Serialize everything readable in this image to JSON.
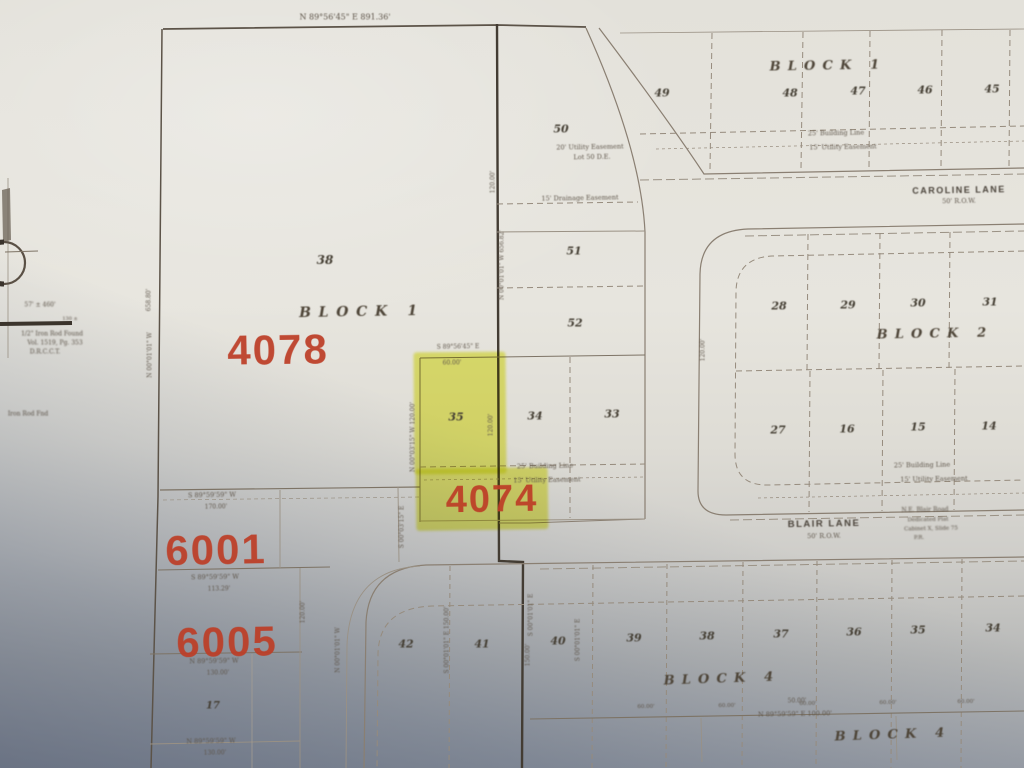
{
  "summary": {
    "highlighted_lot": "35",
    "stamps": [
      "4078",
      "4074",
      "6001",
      "6005"
    ],
    "streets": [
      "CAROLINE LANE",
      "BLAIR LANE"
    ],
    "blocks": [
      "BLOCK 1",
      "BLOCK 2",
      "BLOCK 4"
    ]
  },
  "labels": [
    {
      "name": "stamp-4078",
      "cls": "stamp",
      "text": "4078",
      "x": 278,
      "y": 350,
      "fs": 42,
      "rot": -1
    },
    {
      "name": "stamp-4074",
      "cls": "stamp",
      "text": "4074",
      "x": 492,
      "y": 500,
      "fs": 38,
      "rot": -1
    },
    {
      "name": "stamp-6001",
      "cls": "stamp",
      "text": "6001",
      "x": 216,
      "y": 550,
      "fs": 42,
      "rot": -1
    },
    {
      "name": "stamp-6005",
      "cls": "stamp",
      "text": "6005",
      "x": 227,
      "y": 642,
      "fs": 42,
      "rot": -1
    },
    {
      "name": "block1-right-label",
      "cls": "block",
      "text": "BLOCK 1",
      "x": 828,
      "y": 66,
      "fs": 13,
      "rot": -1
    },
    {
      "name": "block1-left-label",
      "cls": "block",
      "text": "BLOCK 1",
      "x": 362,
      "y": 312,
      "fs": 14,
      "rot": -1
    },
    {
      "name": "block2-label",
      "cls": "block",
      "text": "BLOCK 2",
      "x": 935,
      "y": 334,
      "fs": 13,
      "rot": -1
    },
    {
      "name": "block4-label",
      "cls": "block",
      "text": "BLOCK 4",
      "x": 722,
      "y": 679,
      "fs": 13,
      "rot": -2
    },
    {
      "name": "block4-label-2",
      "cls": "block",
      "text": "BLOCK 4",
      "x": 893,
      "y": 735,
      "fs": 13,
      "rot": -2
    },
    {
      "name": "street-caroline-label",
      "cls": "street",
      "text": "CAROLINE LANE",
      "x": 959,
      "y": 190,
      "fs": 9,
      "rot": -1
    },
    {
      "name": "street-caroline-row",
      "cls": "small",
      "text": "50' R.O.W.",
      "x": 959,
      "y": 201,
      "fs": 6.5,
      "rot": -1
    },
    {
      "name": "street-blair-label",
      "cls": "street",
      "text": "BLAIR LANE",
      "x": 824,
      "y": 524,
      "fs": 9.5,
      "rot": -1
    },
    {
      "name": "street-blair-row",
      "cls": "small",
      "text": "50' R.O.W.",
      "x": 824,
      "y": 536,
      "fs": 6.5,
      "rot": -1
    },
    {
      "name": "lot-49",
      "cls": "lot",
      "text": "49",
      "x": 662,
      "y": 93,
      "fs": 11,
      "rot": 0
    },
    {
      "name": "lot-48",
      "cls": "lot",
      "text": "48",
      "x": 790,
      "y": 93,
      "fs": 11,
      "rot": 0
    },
    {
      "name": "lot-47",
      "cls": "lot",
      "text": "47",
      "x": 858,
      "y": 91,
      "fs": 11,
      "rot": 0
    },
    {
      "name": "lot-46",
      "cls": "lot",
      "text": "46",
      "x": 925,
      "y": 90,
      "fs": 11,
      "rot": 0
    },
    {
      "name": "lot-45",
      "cls": "lot",
      "text": "45",
      "x": 992,
      "y": 89,
      "fs": 11,
      "rot": 0
    },
    {
      "name": "lot-50",
      "cls": "lot",
      "text": "50",
      "x": 561,
      "y": 129,
      "fs": 11,
      "rot": 0
    },
    {
      "name": "lot-38",
      "cls": "lot",
      "text": "38",
      "x": 325,
      "y": 260,
      "fs": 12,
      "rot": 0
    },
    {
      "name": "lot-51",
      "cls": "lot",
      "text": "51",
      "x": 574,
      "y": 251,
      "fs": 11,
      "rot": 0
    },
    {
      "name": "lot-52",
      "cls": "lot",
      "text": "52",
      "x": 575,
      "y": 323,
      "fs": 11,
      "rot": 0
    },
    {
      "name": "lot-35-highlighted",
      "cls": "lot",
      "text": "35",
      "x": 456,
      "y": 417,
      "fs": 11,
      "rot": 0
    },
    {
      "name": "lot-34",
      "cls": "lot",
      "text": "34",
      "x": 535,
      "y": 416,
      "fs": 11,
      "rot": 0
    },
    {
      "name": "lot-33",
      "cls": "lot",
      "text": "33",
      "x": 612,
      "y": 414,
      "fs": 11,
      "rot": 0
    },
    {
      "name": "lot-28",
      "cls": "lot",
      "text": "28",
      "x": 779,
      "y": 306,
      "fs": 11,
      "rot": 0
    },
    {
      "name": "lot-29",
      "cls": "lot",
      "text": "29",
      "x": 848,
      "y": 305,
      "fs": 11,
      "rot": 0
    },
    {
      "name": "lot-30",
      "cls": "lot",
      "text": "30",
      "x": 918,
      "y": 303,
      "fs": 11,
      "rot": 0
    },
    {
      "name": "lot-31",
      "cls": "lot",
      "text": "31",
      "x": 990,
      "y": 302,
      "fs": 11,
      "rot": 0
    },
    {
      "name": "lot-27",
      "cls": "lot",
      "text": "27",
      "x": 778,
      "y": 430,
      "fs": 11,
      "rot": 0
    },
    {
      "name": "lot-16",
      "cls": "lot",
      "text": "16",
      "x": 847,
      "y": 429,
      "fs": 11,
      "rot": 0
    },
    {
      "name": "lot-15",
      "cls": "lot",
      "text": "15",
      "x": 918,
      "y": 427,
      "fs": 11,
      "rot": 0
    },
    {
      "name": "lot-14",
      "cls": "lot",
      "text": "14",
      "x": 989,
      "y": 426,
      "fs": 11,
      "rot": 0
    },
    {
      "name": "lot-42",
      "cls": "lot",
      "text": "42",
      "x": 406,
      "y": 644,
      "fs": 11,
      "rot": 0
    },
    {
      "name": "lot-41",
      "cls": "lot",
      "text": "41",
      "x": 482,
      "y": 644,
      "fs": 11,
      "rot": 0
    },
    {
      "name": "lot-40",
      "cls": "lot",
      "text": "40",
      "x": 558,
      "y": 641,
      "fs": 11,
      "rot": 0
    },
    {
      "name": "lot-39",
      "cls": "lot",
      "text": "39",
      "x": 634,
      "y": 638,
      "fs": 11,
      "rot": 0
    },
    {
      "name": "lot-38b",
      "cls": "lot",
      "text": "38",
      "x": 707,
      "y": 636,
      "fs": 11,
      "rot": 0
    },
    {
      "name": "lot-37",
      "cls": "lot",
      "text": "37",
      "x": 781,
      "y": 634,
      "fs": 11,
      "rot": 0
    },
    {
      "name": "lot-36",
      "cls": "lot",
      "text": "36",
      "x": 854,
      "y": 632,
      "fs": 11,
      "rot": 0
    },
    {
      "name": "lot-35b",
      "cls": "lot",
      "text": "35",
      "x": 918,
      "y": 630,
      "fs": 11,
      "rot": 0
    },
    {
      "name": "lot-34b",
      "cls": "lot",
      "text": "34",
      "x": 993,
      "y": 628,
      "fs": 11,
      "rot": 0
    },
    {
      "name": "lot-17",
      "cls": "lot",
      "text": "17",
      "x": 213,
      "y": 706,
      "fs": 10,
      "rot": 0
    },
    {
      "name": "easement-building-ne",
      "cls": "small",
      "text": "25' Building Line",
      "x": 836,
      "y": 133,
      "fs": 6.5,
      "rot": -1
    },
    {
      "name": "easement-utility-ne",
      "cls": "small",
      "text": "15' Utility Easement",
      "x": 843,
      "y": 147,
      "fs": 6.5,
      "rot": -1
    },
    {
      "name": "easement-utility-lot50",
      "cls": "small",
      "text": "20' Utility Easement",
      "x": 590,
      "y": 147,
      "fs": 6.5,
      "rot": -1
    },
    {
      "name": "easement-lot50-note",
      "cls": "small",
      "text": "Lot 50 D.E.",
      "x": 592,
      "y": 157,
      "fs": 6.5,
      "rot": -1
    },
    {
      "name": "easement-drainage",
      "cls": "small",
      "text": "15' Drainage Easement",
      "x": 580,
      "y": 198,
      "fs": 6.5,
      "rot": -1
    },
    {
      "name": "easement-building-mid",
      "cls": "small",
      "text": "25' Building Line",
      "x": 545,
      "y": 466,
      "fs": 6.5,
      "rot": -1
    },
    {
      "name": "easement-utility-mid",
      "cls": "small",
      "text": "15' Utility Easement",
      "x": 547,
      "y": 480,
      "fs": 6.5,
      "rot": -1
    },
    {
      "name": "easement-building-b2",
      "cls": "small",
      "text": "25' Building Line",
      "x": 922,
      "y": 465,
      "fs": 6.5,
      "rot": -1
    },
    {
      "name": "easement-utility-b2",
      "cls": "small",
      "text": "15' Utility Easement",
      "x": 934,
      "y": 479,
      "fs": 6.5,
      "rot": -1
    },
    {
      "name": "bearing-top",
      "cls": "small",
      "text": "N 89°56'45\" E   891.36'",
      "x": 345,
      "y": 17,
      "fs": 8,
      "rot": 0
    },
    {
      "name": "bearing-lot35-top",
      "cls": "small",
      "text": "S 89°56'45\" E",
      "x": 458,
      "y": 347,
      "fs": 6,
      "rot": -1
    },
    {
      "name": "dim-lot35",
      "cls": "small",
      "text": "60.00'",
      "x": 452,
      "y": 363,
      "fs": 6,
      "rot": -1
    },
    {
      "name": "bearing-6001-n",
      "cls": "small",
      "text": "S 89°59'59\" W",
      "x": 212,
      "y": 495,
      "fs": 6.5,
      "rot": -1
    },
    {
      "name": "dim-6001-n",
      "cls": "small",
      "text": "170.00'",
      "x": 216,
      "y": 507,
      "fs": 6,
      "rot": -1
    },
    {
      "name": "bearing-6001-s",
      "cls": "small",
      "text": "S 89°59'59\" W",
      "x": 215,
      "y": 577,
      "fs": 6.5,
      "rot": -1
    },
    {
      "name": "dim-6001-s",
      "cls": "small",
      "text": "113.29'",
      "x": 219,
      "y": 589,
      "fs": 6,
      "rot": -1
    },
    {
      "name": "bearing-6005-s",
      "cls": "small",
      "text": "N 89°59'59\" W",
      "x": 214,
      "y": 661,
      "fs": 6.5,
      "rot": -1
    },
    {
      "name": "dim-6005-s",
      "cls": "small",
      "text": "130.00'",
      "x": 218,
      "y": 673,
      "fs": 6,
      "rot": -1
    },
    {
      "name": "bearing-lot17-s",
      "cls": "small",
      "text": "N 89°59'59\" W",
      "x": 211,
      "y": 741,
      "fs": 6.5,
      "rot": -1
    },
    {
      "name": "dim-lot17-s",
      "cls": "small",
      "text": "130.00'",
      "x": 215,
      "y": 753,
      "fs": 6,
      "rot": -1
    },
    {
      "name": "dim-50",
      "cls": "small",
      "text": "50.00'",
      "x": 797,
      "y": 701,
      "fs": 6,
      "rot": -1
    },
    {
      "name": "bearing-b4-s",
      "cls": "small",
      "text": "N 89°59'59\" E   100.00'",
      "x": 795,
      "y": 714,
      "fs": 6.5,
      "rot": -1
    },
    {
      "name": "dim-b4-1",
      "cls": "small",
      "text": "60.00'",
      "x": 646,
      "y": 707,
      "fs": 5.5,
      "rot": -1
    },
    {
      "name": "dim-b4-2",
      "cls": "small",
      "text": "60.00'",
      "x": 727,
      "y": 706,
      "fs": 5.5,
      "rot": -1
    },
    {
      "name": "dim-b4-3",
      "cls": "small",
      "text": "60.00'",
      "x": 808,
      "y": 704,
      "fs": 5.5,
      "rot": -1
    },
    {
      "name": "dim-b4-4",
      "cls": "small",
      "text": "60.00'",
      "x": 888,
      "y": 703,
      "fs": 5.5,
      "rot": -1
    },
    {
      "name": "dim-b4-5",
      "cls": "small",
      "text": "60.00'",
      "x": 966,
      "y": 702,
      "fs": 5.5,
      "rot": -1
    },
    {
      "name": "blair-note-1",
      "cls": "note",
      "text": "N.E.   Blair Road",
      "x": 925,
      "y": 510,
      "fs": 6,
      "rot": -1
    },
    {
      "name": "blair-note-2",
      "cls": "note",
      "text": "Dedicated Plat",
      "x": 928,
      "y": 520,
      "fs": 5.5,
      "rot": -1
    },
    {
      "name": "blair-note-3",
      "cls": "note",
      "text": "Cabinet X, Slide 75",
      "x": 931,
      "y": 529,
      "fs": 5.5,
      "rot": -1
    },
    {
      "name": "blair-note-4",
      "cls": "note",
      "text": "P.R.",
      "x": 919,
      "y": 538,
      "fs": 5.5,
      "rot": -1
    },
    {
      "name": "vbearing-east-line",
      "cls": "vert",
      "text": "N 00°01'01\" W   656.82'",
      "x": 502,
      "y": 265,
      "fs": 6,
      "rot": -90
    },
    {
      "name": "vdim-east-line",
      "cls": "vert",
      "text": "120.00'",
      "x": 493,
      "y": 182,
      "fs": 6,
      "rot": -90
    },
    {
      "name": "vdim-lot35-e",
      "cls": "vert",
      "text": "120.00'",
      "x": 491,
      "y": 425,
      "fs": 6,
      "rot": -90
    },
    {
      "name": "vbearing-lot35-w",
      "cls": "vert",
      "text": "N 00°03'15\" W  120.00'",
      "x": 413,
      "y": 437,
      "fs": 6,
      "rot": -90
    },
    {
      "name": "vbearing-heavy-s1",
      "cls": "vert",
      "text": "S 00°01'01\" E",
      "x": 531,
      "y": 615,
      "fs": 6,
      "rot": -90
    },
    {
      "name": "vdim-heavy-s1",
      "cls": "vert",
      "text": "150.00'",
      "x": 528,
      "y": 655,
      "fs": 6,
      "rot": -90
    },
    {
      "name": "vbearing-6005-e",
      "cls": "vert",
      "text": "N 00°01'01\" W",
      "x": 338,
      "y": 650,
      "fs": 6,
      "rot": -90
    },
    {
      "name": "vdim-6005-e",
      "cls": "vert",
      "text": "120.00'",
      "x": 303,
      "y": 612,
      "fs": 6,
      "rot": -90
    },
    {
      "name": "vbearing-6001-e",
      "cls": "vert",
      "text": "S 00°03'15\" E",
      "x": 402,
      "y": 527,
      "fs": 6,
      "rot": -90
    },
    {
      "name": "vbearing-lot42-w",
      "cls": "vert",
      "text": "S 00°01'01\" E  150.00'",
      "x": 447,
      "y": 640,
      "fs": 6,
      "rot": -90
    },
    {
      "name": "vbearing-lot40-w",
      "cls": "vert",
      "text": "S 00°01'01\" E",
      "x": 578,
      "y": 640,
      "fs": 6,
      "rot": -90
    },
    {
      "name": "vbearing-west-line",
      "cls": "vert",
      "text": "N 00°01'01\" W",
      "x": 150,
      "y": 355,
      "fs": 6,
      "rot": -90
    },
    {
      "name": "vdim-west-line",
      "cls": "vert",
      "text": "658.80'",
      "x": 149,
      "y": 300,
      "fs": 6,
      "rot": -90
    },
    {
      "name": "vdim-block2-w",
      "cls": "vert",
      "text": "120.00'",
      "x": 703,
      "y": 350,
      "fs": 6,
      "rot": -90
    },
    {
      "name": "margin-note-1",
      "cls": "note",
      "text": "57' ± 460'",
      "x": 40,
      "y": 305,
      "fs": 6,
      "rot": 0
    },
    {
      "name": "margin-note-2",
      "cls": "note",
      "text": "130 ±",
      "x": 70,
      "y": 319,
      "fs": 5,
      "rot": 0
    },
    {
      "name": "margin-note-3",
      "cls": "note",
      "text": "1/2\" Iron Rod Found",
      "x": 52,
      "y": 334,
      "fs": 6,
      "rot": 0
    },
    {
      "name": "margin-note-4",
      "cls": "note",
      "text": "Vol. 1519, Pg. 353",
      "x": 55,
      "y": 343,
      "fs": 6,
      "rot": 0
    },
    {
      "name": "margin-note-5",
      "cls": "note",
      "text": "D.R.C.C.T.",
      "x": 45,
      "y": 352,
      "fs": 6,
      "rot": 0
    },
    {
      "name": "margin-note-6",
      "cls": "note",
      "text": "Iron Rod Fnd",
      "x": 28,
      "y": 414,
      "fs": 6,
      "rot": 0
    }
  ]
}
